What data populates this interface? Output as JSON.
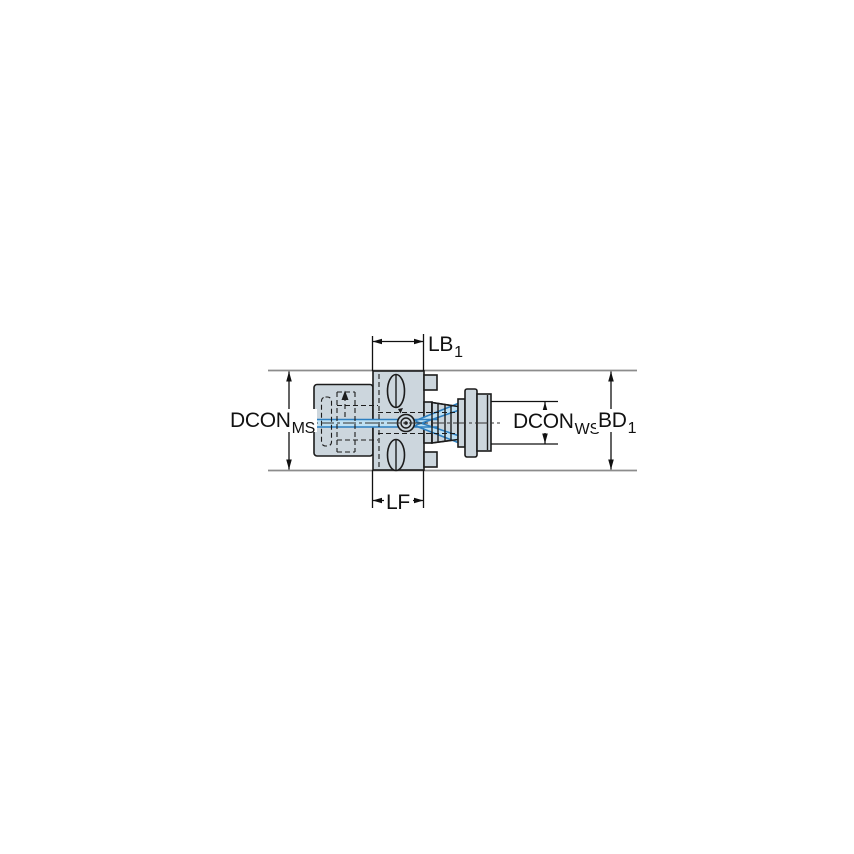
{
  "diagram": {
    "kind": "technical-dimension-drawing",
    "subject": "milling adapter side view with coolant channel",
    "labels": {
      "lb1": {
        "main": "LB",
        "sub": "1"
      },
      "dcon_ms": {
        "main": "DCON",
        "sub": "MS"
      },
      "dcon_ws": {
        "main": "DCON",
        "sub": "WS"
      },
      "bd1": {
        "main": "BD",
        "sub": "1"
      },
      "lf": {
        "main": "LF",
        "sub": ""
      }
    },
    "colors": {
      "background": "#ffffff",
      "part_fill": "#ccd6dd",
      "part_outline": "#1c1c1c",
      "coolant_stroke": "#2d7fc0",
      "coolant_fill": "#bfe0f2",
      "extension_line": "#8c8c8c",
      "dimension_line": "#111111"
    }
  }
}
